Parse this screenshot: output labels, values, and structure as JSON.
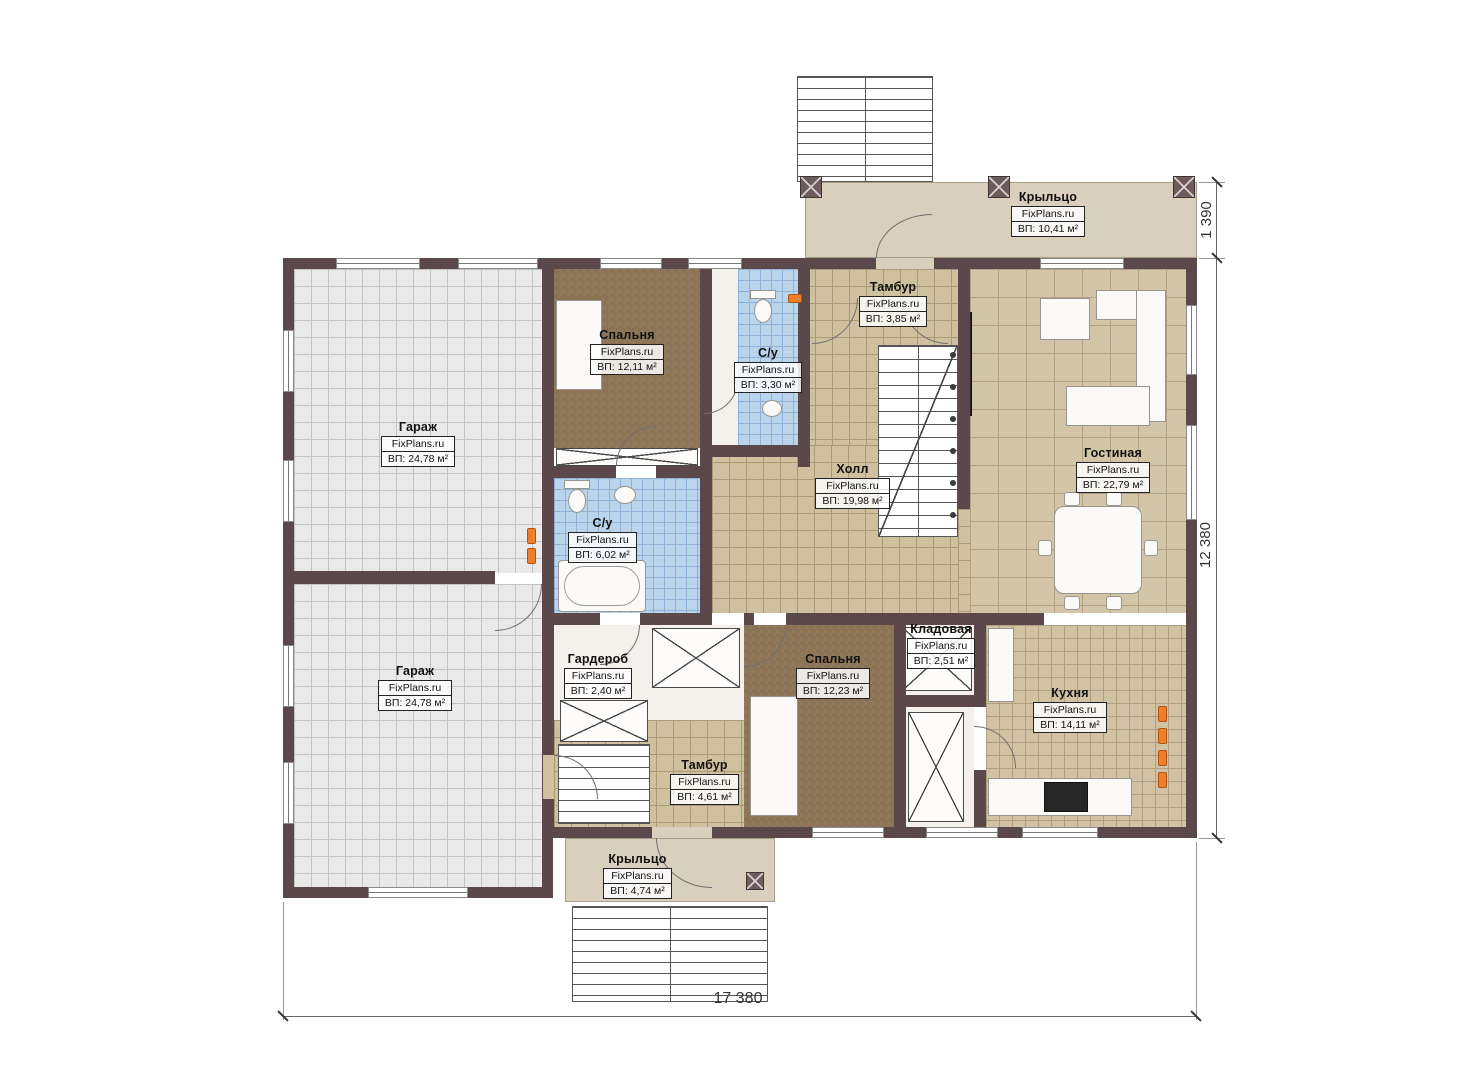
{
  "plan": {
    "brand": "FixPlans.ru",
    "rooms": [
      {
        "name": "Крыльцо",
        "area": "ВП: 10,41 м²"
      },
      {
        "name": "Гараж",
        "area": "ВП: 24,78 м²"
      },
      {
        "name": "Гараж",
        "area": "ВП: 24,78 м²"
      },
      {
        "name": "Спальня",
        "area": "ВП: 12,11 м²"
      },
      {
        "name": "С/у",
        "area": "ВП: 3,30 м²"
      },
      {
        "name": "Тамбур",
        "area": "ВП: 3,85 м²"
      },
      {
        "name": "Холл",
        "area": "ВП: 19,98 м²"
      },
      {
        "name": "Гостиная",
        "area": "ВП: 22,79 м²"
      },
      {
        "name": "С/у",
        "area": "ВП: 6,02 м²"
      },
      {
        "name": "Гардероб",
        "area": "ВП: 2,40 м²"
      },
      {
        "name": "Спальня",
        "area": "ВП: 12,23 м²"
      },
      {
        "name": "Кладовая",
        "area": "ВП: 2,51 м²"
      },
      {
        "name": "Кухня",
        "area": "ВП: 14,11 м²"
      },
      {
        "name": "Тамбур",
        "area": "ВП: 4,61 м²"
      },
      {
        "name": "Крыльцо",
        "area": "ВП: 4,74 м²"
      }
    ],
    "dimensions": {
      "bottom": "17 380",
      "right": "12 380",
      "top_right": "1 390"
    },
    "colors": {
      "wall": "#5a484b",
      "porch": "#d9cfbd",
      "marker": "#ef7d2e"
    }
  }
}
